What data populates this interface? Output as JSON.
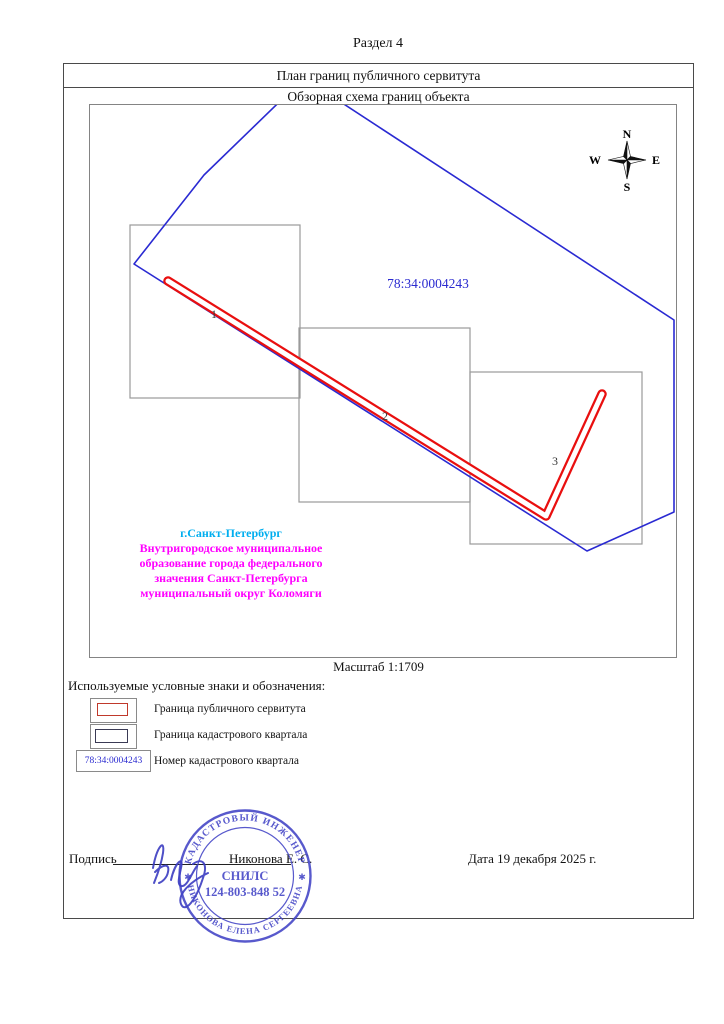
{
  "page": {
    "section_title": "Раздел 4"
  },
  "header": {
    "plan_title": "План границ публичного сервитута",
    "scheme_title": "Обзорная схема границ объекта"
  },
  "map": {
    "cadastral_number": "78:34:0004243",
    "scale_label": "Масштаб 1:1709",
    "sheet_labels": [
      "1",
      "2",
      "3"
    ],
    "compass": {
      "n": "N",
      "e": "E",
      "s": "S",
      "w": "W"
    },
    "location_lines": [
      "г.Санкт-Петербург",
      "Внутригородское муниципальное",
      "образование города федерального",
      "значения Санкт-Петербурга",
      "муниципальный округ Коломяги"
    ],
    "colors": {
      "servitude_boundary": "#e90f0f",
      "quarter_boundary": "#2a2ad2",
      "city_label": "#00aeef",
      "municipal_label": "#ff00ff",
      "cadastral_number_text": "#2b2bd0"
    }
  },
  "legend": {
    "title": "Используемые условные знаки и обозначения:",
    "item1_label": "Граница публичного сервитута",
    "item2_label": "Граница кадастрового квартала",
    "item3_symbol": "78:34:0004243",
    "item3_label": "Номер кадастрового квартала"
  },
  "signature": {
    "label": "Подпись",
    "name": "Никонова Е. С.",
    "date": "Дата 19 декабря 2025 г."
  },
  "stamp": {
    "arc_top": "КАДАСТРОВЫЙ ИНЖЕНЕР",
    "arc_bottom": "НИКОНОВА ЕЛЕНА СЕРГЕЕВНА",
    "center_line1": "СНИЛС",
    "center_line2": "124-803-848 52",
    "star": "✱",
    "color": "#4143c6"
  }
}
